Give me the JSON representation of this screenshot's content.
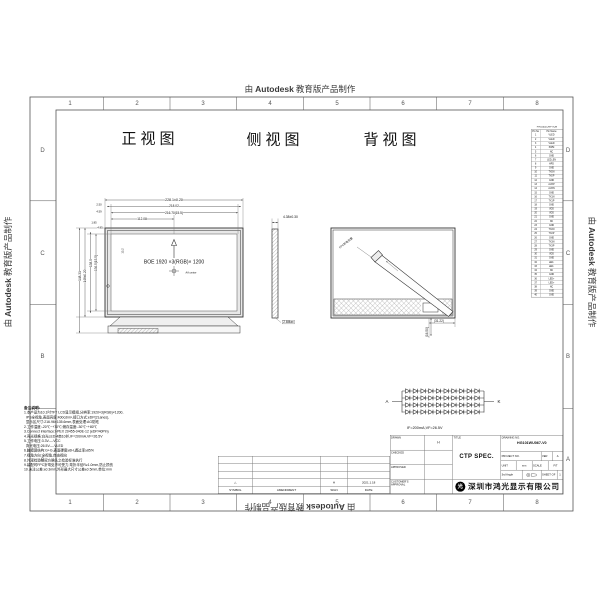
{
  "watermark": {
    "prefix": "由",
    "brand": "Autodesk",
    "suffix": "教育版产品制作"
  },
  "sheet": {
    "zone_numbers": [
      "1",
      "2",
      "3",
      "4",
      "5",
      "6",
      "7",
      "8"
    ],
    "zone_letters": [
      "D",
      "C",
      "B",
      "A"
    ]
  },
  "views": {
    "front": {
      "label": "正视图",
      "dims_top": [
        "228.1±0.20",
        "218.02",
        "216.70(15.5)",
        "112.08"
      ],
      "dims_top_small": [
        "2.50",
        "4.59"
      ],
      "dims_left": [
        "148.31",
        "148±0.20",
        "138.5",
        "136.5(15.5)"
      ],
      "dims_left_small": [
        "1.85",
        "4.85"
      ],
      "dim_inner": "13.2",
      "screen_text": "BOE 1920 ×3(RGB)× 1200",
      "center_note": "AA center"
    },
    "side": {
      "label": "侧视图",
      "dim_top": "4.38±0.30",
      "note": "2.6Max"
    },
    "back": {
      "label": "背视图",
      "dim_w": "(31.22)",
      "dim_h": "(16.50)",
      "fpc_note": "FPC折弯位置"
    }
  },
  "backlight": {
    "a": "A",
    "k": "K",
    "spec": "IF=200mA;VF=26.5V"
  },
  "pin_table": {
    "title": "PIN DESCRIPTION",
    "col_no": "Pin No",
    "col_name": "Pin Name",
    "pins": [
      "VLED",
      "VLED",
      "VLED",
      "PWM",
      "NC",
      "GND",
      "LED_EN",
      "HPD",
      "GND",
      "TX0N",
      "TX0P",
      "GND",
      "AUXP",
      "AUXN",
      "GND",
      "TX1N",
      "TX1P",
      "GND",
      "VDD",
      "VDD",
      "GND",
      "NC",
      "GND",
      "TX2N",
      "TX2P",
      "GND",
      "TX3N",
      "TX3P",
      "GND",
      "VDD",
      "GND",
      "LED-",
      "LED-",
      "NC",
      "GND",
      "LED+",
      "LED+",
      "NC",
      "GND",
      "GND"
    ]
  },
  "notes": {
    "heading": "备注说明:",
    "lines": [
      "1.本产品为10.1吋TFT LCD显示模组,分辨率:1920×3(RGB)×1200,",
      "  IPS全视角,表面亮度:400cd/m²,接口方式:eDP(2Lanes),",
      "  显示区尺寸:216.96×135.6mm,表面处理:AG防眩",
      "2.工作温度:-20℃~+70℃;储存温度:-30℃~+80℃",
      "3.Connect interface:I-PEX 20455-040E-12 (eDP/40Pin)",
      "4.背光规格:白光LED 4串10并,IF=200mA,VF=26.5V",
      "5.工作电压:3.3V----VCC",
      "  背光电压:26.5V----VLED",
      "6.触摸屏结构:G+G,表面硬度≥6H,透过率≥85%",
      "7.视角方向:全视角,自由视向",
      "8.外观检验按双方确认之检验标准执行",
      "9.装配时FPC折弯处不可受力,弯折半径R≥1.0mm,防止损伤",
      "10.未注公差:±0.3mm,外形最大尺寸公差±0.5mm,单位:mm"
    ]
  },
  "revision": {
    "headers": [
      "SYMBOL",
      "AMENDMENT",
      "SIGN",
      "DATE"
    ],
    "symbol": "△",
    "sign": "H",
    "date": "2021.1.18"
  },
  "title_block": {
    "drawn_label": "DRAWN",
    "drawn_value": "H",
    "checked_label": "CHECKED",
    "approved_label": "APPROVED",
    "customer_label": "CUSTOMER'S",
    "customer_label2": "APPROVAL",
    "title_label": "TITLE",
    "title_value": "CTP SPEC.",
    "drawing_no_label": "DRAWING NO.",
    "drawing_no_value": "HG101WU067-V0",
    "project_no_label": "PROJECT NO.",
    "ver_label": "VER",
    "ver_value": "A",
    "unit_label": "UNIT",
    "unit_value": "mm",
    "scale_label": "SCALE",
    "scale_value": "FIT",
    "angle_label": "3rd Angle",
    "sheet_label": "SHEET",
    "of_label": "OF",
    "sheet_value": "1",
    "company": "深圳市鸿光显示有限公司"
  }
}
